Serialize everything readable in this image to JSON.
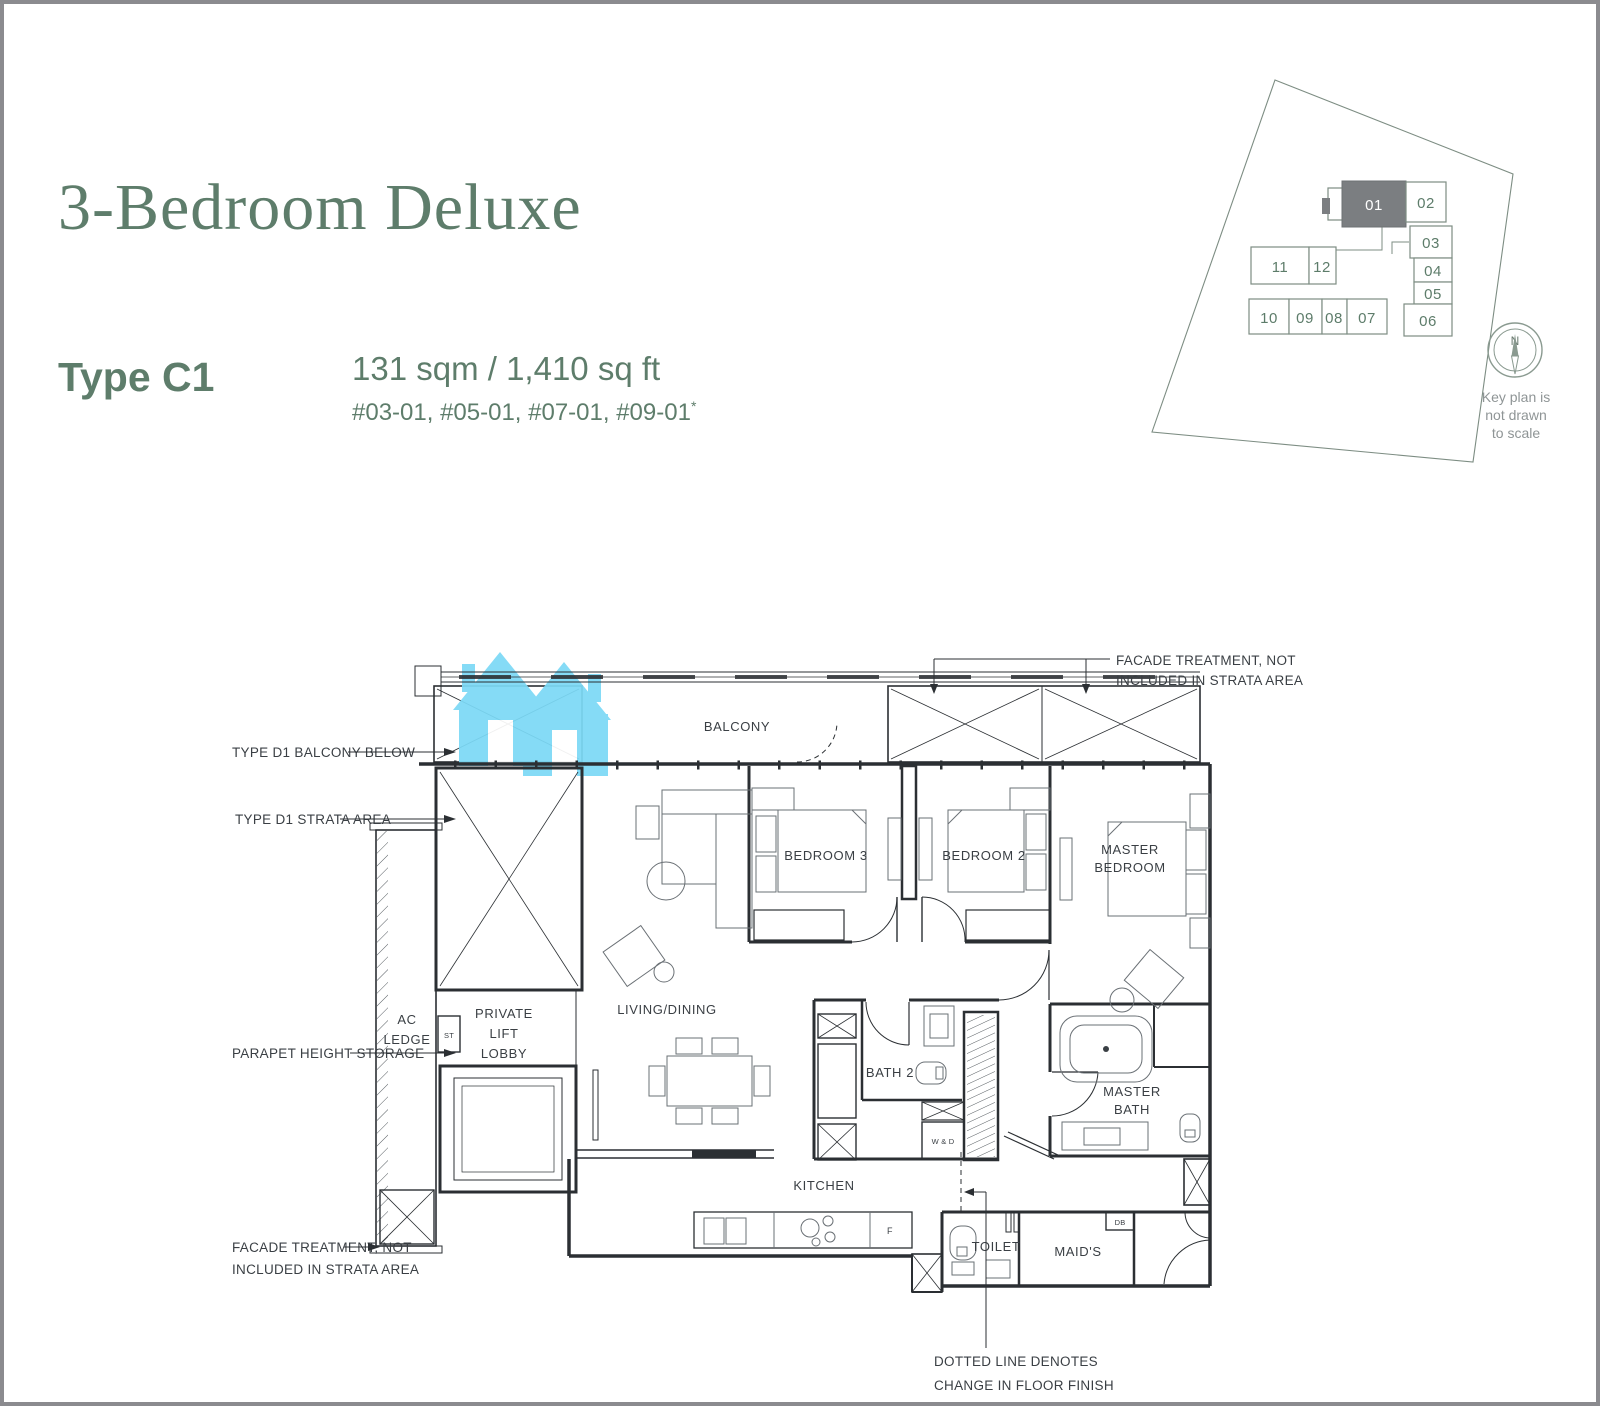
{
  "header": {
    "title": "3-Bedroom Deluxe",
    "type_label": "Type C1",
    "area_text": "131 sqm / 1,410 sq ft",
    "units_text": "#03-01, #05-01, #07-01, #09-01",
    "units_superscript": "*"
  },
  "key_plan": {
    "compass_north": "N",
    "note_line1": "Key plan is",
    "note_line2": "not drawn",
    "note_line3": "to scale",
    "highlighted_unit": "01",
    "units": [
      "01",
      "02",
      "03",
      "04",
      "05",
      "06",
      "07",
      "08",
      "09",
      "10",
      "11",
      "12"
    ]
  },
  "floor_plan": {
    "labels": {
      "balcony": "BALCONY",
      "bedroom3": "BEDROOM 3",
      "bedroom2": "BEDROOM 2",
      "master_bedroom_line1": "MASTER",
      "master_bedroom_line2": "BEDROOM",
      "living_dining": "LIVING/DINING",
      "ac_ledge_line1": "AC",
      "ac_ledge_line2": "LEDGE",
      "st": "ST",
      "lobby_line1": "PRIVATE",
      "lobby_line2": "LIFT",
      "lobby_line3": "LOBBY",
      "bath2": "BATH 2",
      "wd": "W & D",
      "master_bath_line1": "MASTER",
      "master_bath_line2": "BATH",
      "kitchen": "KITCHEN",
      "fridge": "F",
      "toilet": "TOILET",
      "maids": "MAID'S",
      "db": "DB"
    },
    "annotations": {
      "type_d1_balcony_below": "TYPE D1 BALCONY BELOW",
      "type_d1_strata_area": "TYPE D1 STRATA AREA",
      "parapet_height_storage": "PARAPET HEIGHT STORAGE",
      "facade_treatment_line1": "FACADE TREATMENT, NOT",
      "facade_treatment_line2": "INCLUDED IN STRATA AREA",
      "dotted_note_line1": "DOTTED LINE DENOTES",
      "dotted_note_line2": "CHANGE IN FLOOR FINISH"
    }
  },
  "colors": {
    "accent_green": "#5e7d6b",
    "keyplan_number_green": "#5d7c6a",
    "keyplan_highlight_gray": "#7b7e81",
    "watermark_blue": "#7cd9f6",
    "frame_gray": "#8b8b8f",
    "line_dark": "#2b2f33"
  }
}
